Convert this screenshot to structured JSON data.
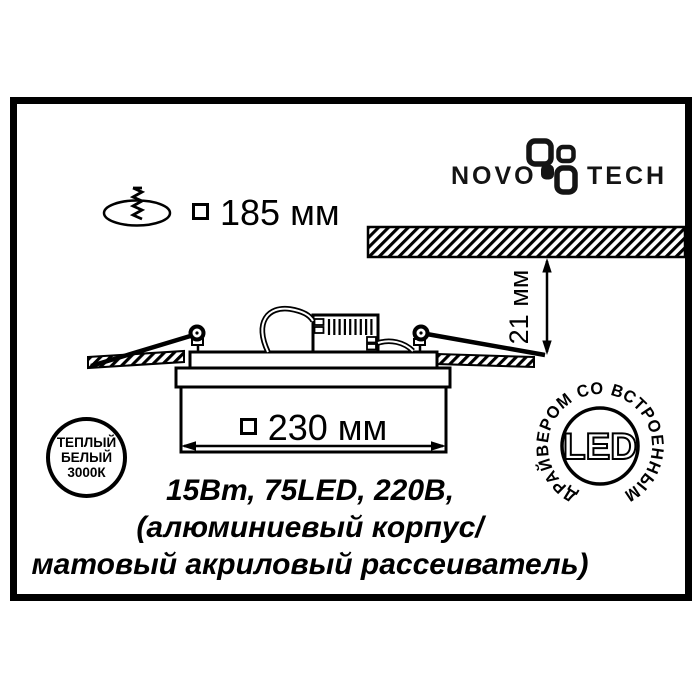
{
  "colors": {
    "ink": "#000000",
    "paper": "#ffffff"
  },
  "logo": {
    "word_left": "NOVO",
    "word_right": "TECH"
  },
  "cutout": {
    "size_label": "185 мм"
  },
  "recess_depth": {
    "label": "21 мм"
  },
  "fixture_width": {
    "label": "230 мм"
  },
  "warm_badge": {
    "line1": "ТЕПЛЫЙ",
    "line2": "БЕЛЫЙ",
    "line3": "3000К"
  },
  "led_badge": {
    "ring_text": "ДРАЙВЕРОМ СО ВСТРОЕННЫМ",
    "center_text": "LED"
  },
  "specs": {
    "line1": "15Вт, 75LED, 220В,",
    "line2": "(алюминиевый корпус/",
    "line3": "матовый акриловый рассеиватель)"
  }
}
